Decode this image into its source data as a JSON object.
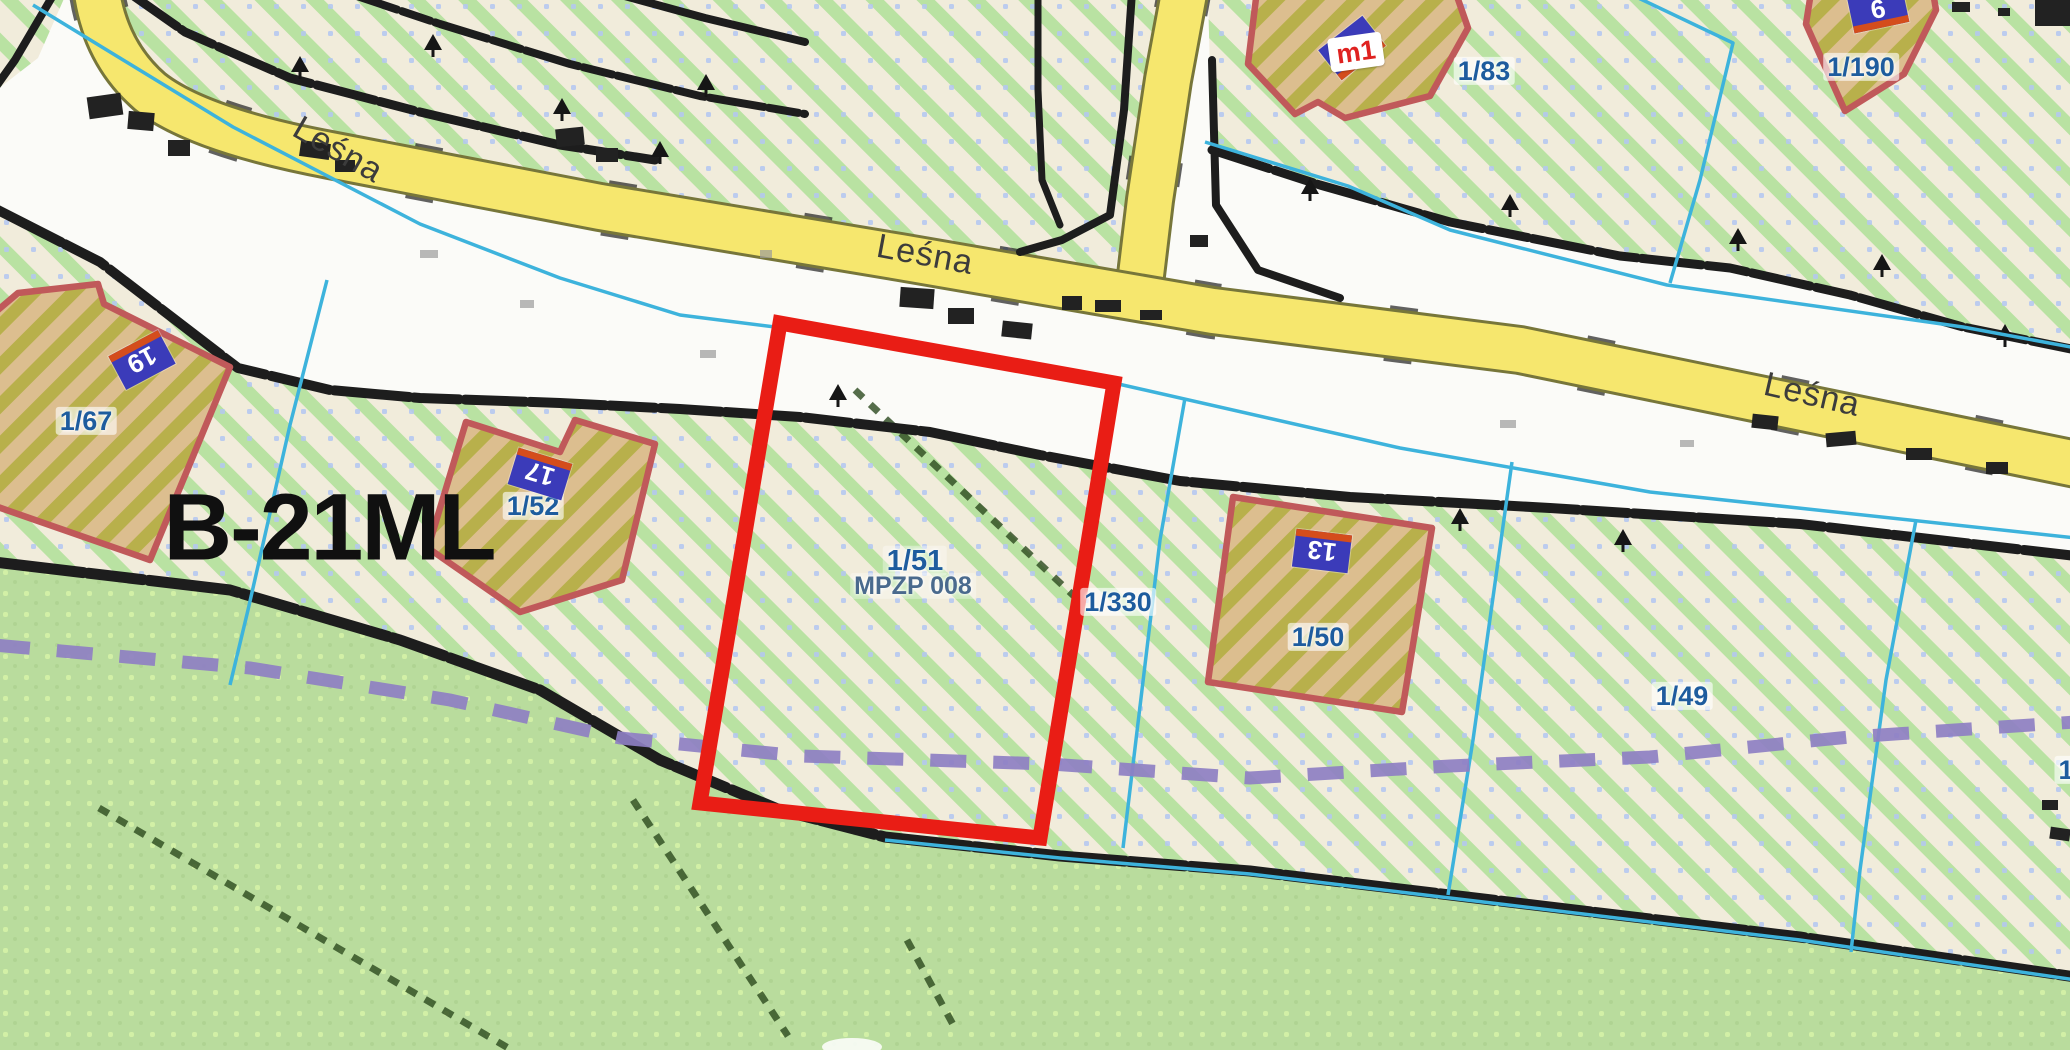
{
  "map": {
    "type": "cadastral-zoning-map",
    "zone": {
      "label": "B-21ML"
    },
    "streets": [
      {
        "name": "Leśna"
      },
      {
        "name": "Leśna"
      },
      {
        "name": "Leśna"
      }
    ],
    "selected_parcel": {
      "number": "1/51",
      "plan_ref": "MPZP 008"
    },
    "parcels": [
      {
        "number": "1/67"
      },
      {
        "number": "1/52"
      },
      {
        "number": "1/330"
      },
      {
        "number": "1/50"
      },
      {
        "number": "1/49"
      },
      {
        "number": "1/83"
      },
      {
        "number": "1/190"
      },
      {
        "number": "1"
      }
    ],
    "address_plates": [
      {
        "number": "19"
      },
      {
        "number": "17"
      },
      {
        "number": "13"
      },
      {
        "number": "m1"
      },
      {
        "number": "6"
      }
    ],
    "colors": {
      "highlight_red": "#e91d15",
      "parcel_line_cyan": "#3db3dc",
      "planning_boundary_purple": "#8e7fc3",
      "road_yellow": "#f6e76e",
      "forest_green": "#b9dc9d",
      "hatch_green": "#b9e2a2",
      "hatch_base_cream": "#f1ecdb",
      "building_fill_olive": "#b8b04b",
      "building_fill_tan": "#dcbe8f",
      "building_outline_rose": "#c0595a",
      "address_plate_blue": "#3b3bb9",
      "address_plate_strip_orange": "#d44d1c",
      "parcel_label_blue": "#1e5c9e"
    }
  }
}
